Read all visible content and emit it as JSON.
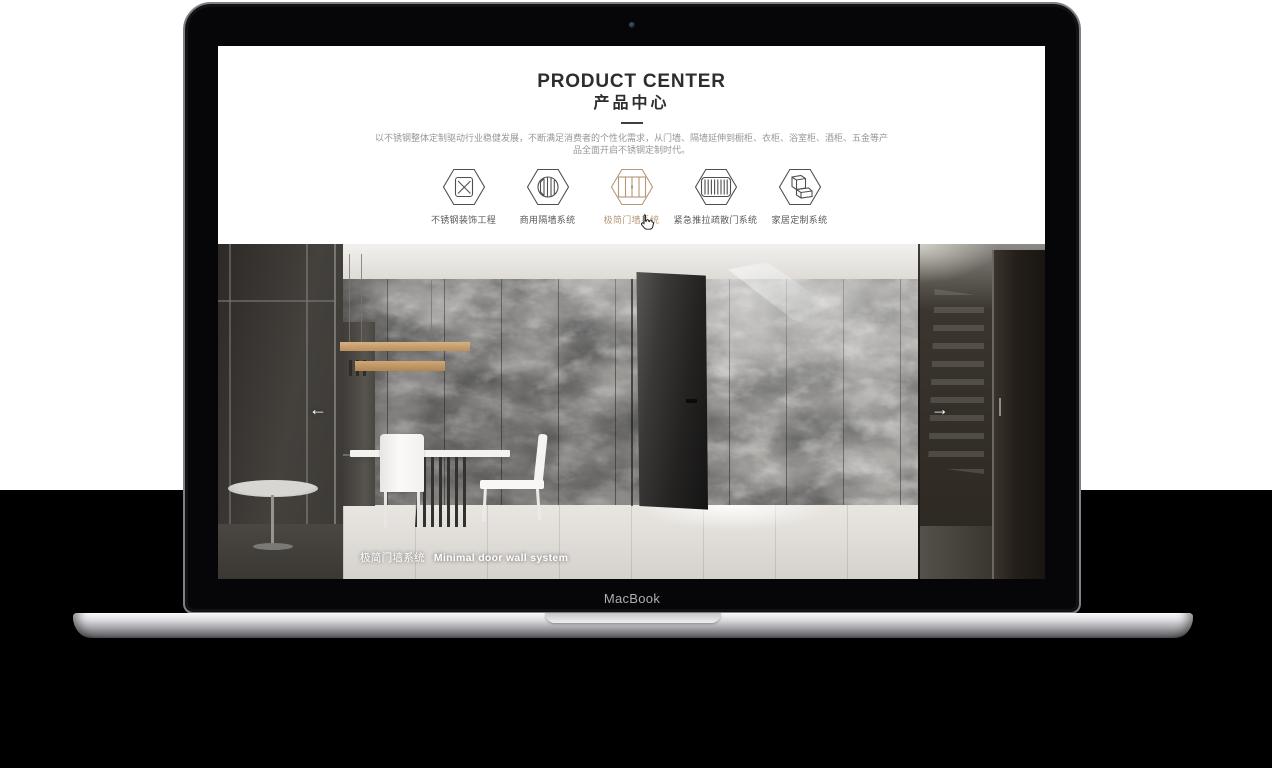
{
  "laptop": {
    "brand_label": "MacBook"
  },
  "product_center": {
    "title_en": "PRODUCT CENTER",
    "title_cn": "产品中心",
    "intro_line1": "以不锈钢整体定制驱动行业稳健发展，不断满足消费者的个性化需求，从门墙、隔墙延伸到橱柜、衣柜、浴室柜、酒柜、五金等产",
    "intro_line2": "品全面开启不锈钢定制时代。",
    "active_color": "#b5987a",
    "inactive_color": "#4f4f4f",
    "categories": [
      {
        "label": "不锈钢装饰工程",
        "icon": "hex-panel-x-icon",
        "active": false
      },
      {
        "label": "商用隔墙系统",
        "icon": "hex-round-partition-icon",
        "active": false
      },
      {
        "label": "极简门墙系统",
        "icon": "hex-door-wall-icon",
        "active": true
      },
      {
        "label": "紧急推拉疏散门系统",
        "icon": "hex-evac-door-icon",
        "active": false
      },
      {
        "label": "家居定制系统",
        "icon": "hex-cabinet-icon",
        "active": false
      }
    ]
  },
  "carousel": {
    "caption_cn": "极简门墙系统",
    "caption_en": "Minimal door wall system",
    "prev_arrow": "←",
    "next_arrow": "→"
  }
}
